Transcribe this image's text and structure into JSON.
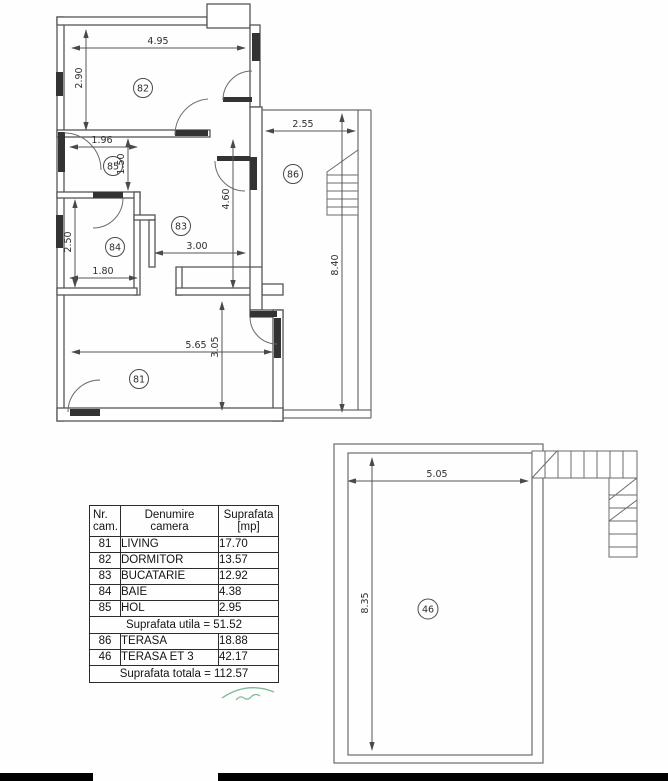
{
  "plan": {
    "rooms": {
      "r81": "81",
      "r82": "82",
      "r83": "83",
      "r84": "84",
      "r85": "85",
      "r86": "86",
      "r46": "46"
    },
    "dimensions": {
      "d495": "4.95",
      "d290": "2.90",
      "d196": "1.96",
      "d150": "1.50",
      "d250": "2.50",
      "d180": "1.80",
      "d300": "3.00",
      "d460": "4.60",
      "d255": "2.55",
      "d840": "8.40",
      "d565": "5.65",
      "d305": "3.05",
      "d505": "5.05",
      "d835": "8.35"
    }
  },
  "table": {
    "headers": {
      "nr": "Nr.\ncam.",
      "name": "Denumire\ncamera",
      "area": "Suprafata\n[mp]"
    },
    "rows": [
      {
        "nr": "81",
        "name": "LIVING",
        "area": "17.70"
      },
      {
        "nr": "82",
        "name": "DORMITOR",
        "area": "13.57"
      },
      {
        "nr": "83",
        "name": "BUCATARIE",
        "area": "12.92"
      },
      {
        "nr": "84",
        "name": "BAIE",
        "area": "4.38"
      },
      {
        "nr": "85",
        "name": "HOL",
        "area": "2.95"
      }
    ],
    "subtotal": "Suprafata utila = 51.52",
    "rows2": [
      {
        "nr": "86",
        "name": "TERASA",
        "area": "18.88"
      },
      {
        "nr": "46",
        "name": "TERASA ET 3",
        "area": "42.17"
      }
    ],
    "total": "Suprafata totala = 112.57"
  },
  "colors": {
    "wall_line": "#565656",
    "thin_line": "#6b6b6b",
    "dark_fill": "#333333",
    "stamp_green": "#66b08b"
  }
}
